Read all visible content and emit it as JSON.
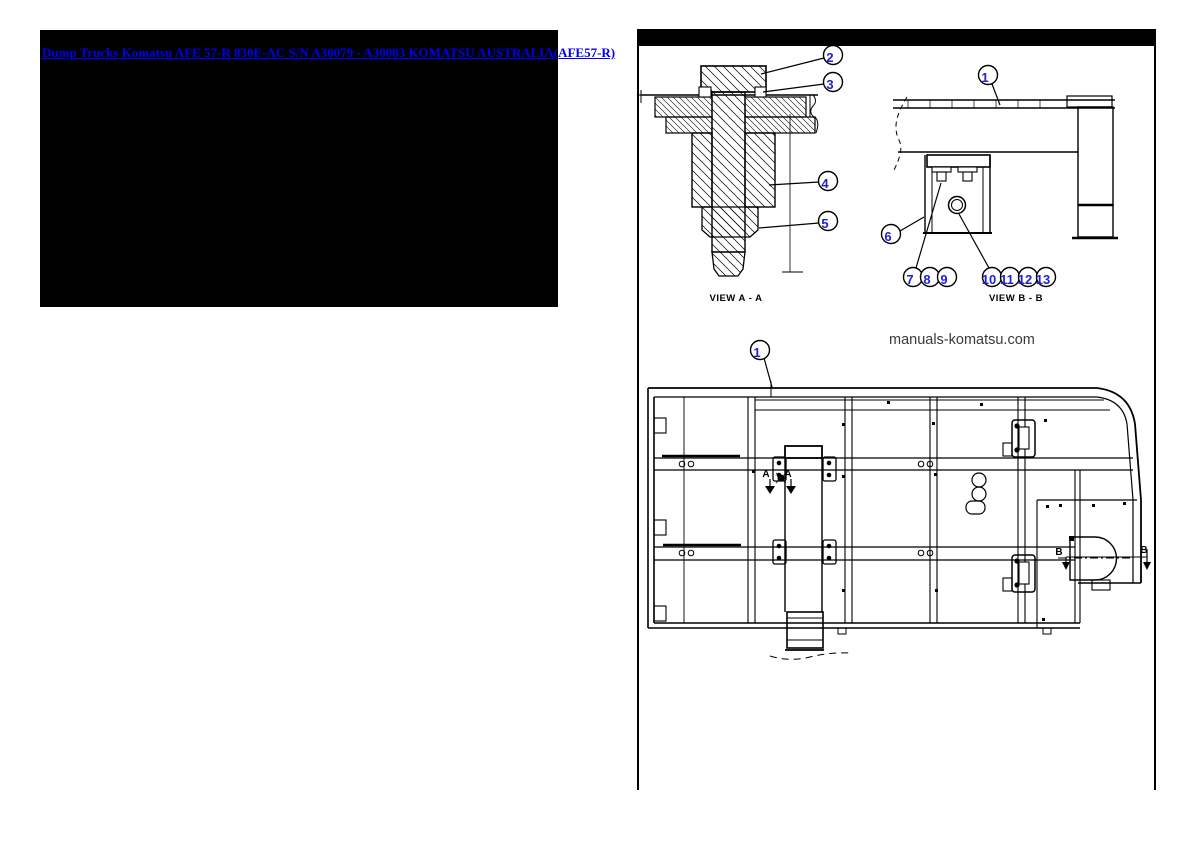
{
  "page": {
    "width": 1190,
    "height": 842,
    "background": "#ffffff"
  },
  "link_panel": {
    "background": "#000000",
    "link": {
      "text": "Dump Trucks Komatsu AFE 57-R 830E-AC S/N A30079 - A30083 KOMATSU AUSTRALIA(AFE57-R)",
      "color": "#0000EE"
    }
  },
  "diagram_panel": {
    "header_color": "#000000",
    "border_color": "#000000",
    "watermark_text": "manuals-komatsu.com",
    "view_a_label": "VIEW A - A",
    "view_b_label": "VIEW B - B",
    "callout_style": {
      "number_color": "#2222CC",
      "circle_stroke": "#000000",
      "radius": 9.5
    },
    "callouts": [
      {
        "n": "1",
        "x": 988,
        "y": 75,
        "leader": [
          992,
          84,
          1000,
          105
        ]
      },
      {
        "n": "2",
        "x": 833,
        "y": 55,
        "leader": [
          824,
          58,
          761,
          74
        ]
      },
      {
        "n": "3",
        "x": 833,
        "y": 82,
        "leader": [
          824,
          84,
          763,
          92
        ]
      },
      {
        "n": "4",
        "x": 828,
        "y": 181,
        "leader": [
          819,
          182,
          769,
          185
        ]
      },
      {
        "n": "5",
        "x": 828,
        "y": 221,
        "leader": [
          819,
          223,
          759,
          228
        ]
      },
      {
        "n": "6",
        "x": 891,
        "y": 234,
        "leader": [
          900,
          231,
          924,
          217
        ]
      },
      {
        "n": "7",
        "x": 913,
        "y": 277,
        "leader": [
          916,
          268,
          941,
          183
        ]
      },
      {
        "n": "8",
        "x": 930,
        "y": 277,
        "leader": null
      },
      {
        "n": "9",
        "x": 947,
        "y": 277,
        "leader": null
      },
      {
        "n": "10",
        "x": 992,
        "y": 277,
        "leader": [
          989,
          268,
          959,
          214
        ]
      },
      {
        "n": "11",
        "x": 1010,
        "y": 277,
        "leader": null
      },
      {
        "n": "12",
        "x": 1028,
        "y": 277,
        "leader": null
      },
      {
        "n": "13",
        "x": 1046,
        "y": 277,
        "leader": null
      },
      {
        "n": "1",
        "x": 760,
        "y": 350,
        "leader": [
          764,
          358,
          772,
          387
        ]
      }
    ],
    "section_markers": [
      {
        "label": "A",
        "x": 766,
        "y": 477
      },
      {
        "label": "A",
        "x": 788,
        "y": 477
      },
      {
        "label": "B",
        "x": 1059,
        "y": 555
      },
      {
        "label": "B",
        "x": 1144,
        "y": 553
      }
    ]
  }
}
